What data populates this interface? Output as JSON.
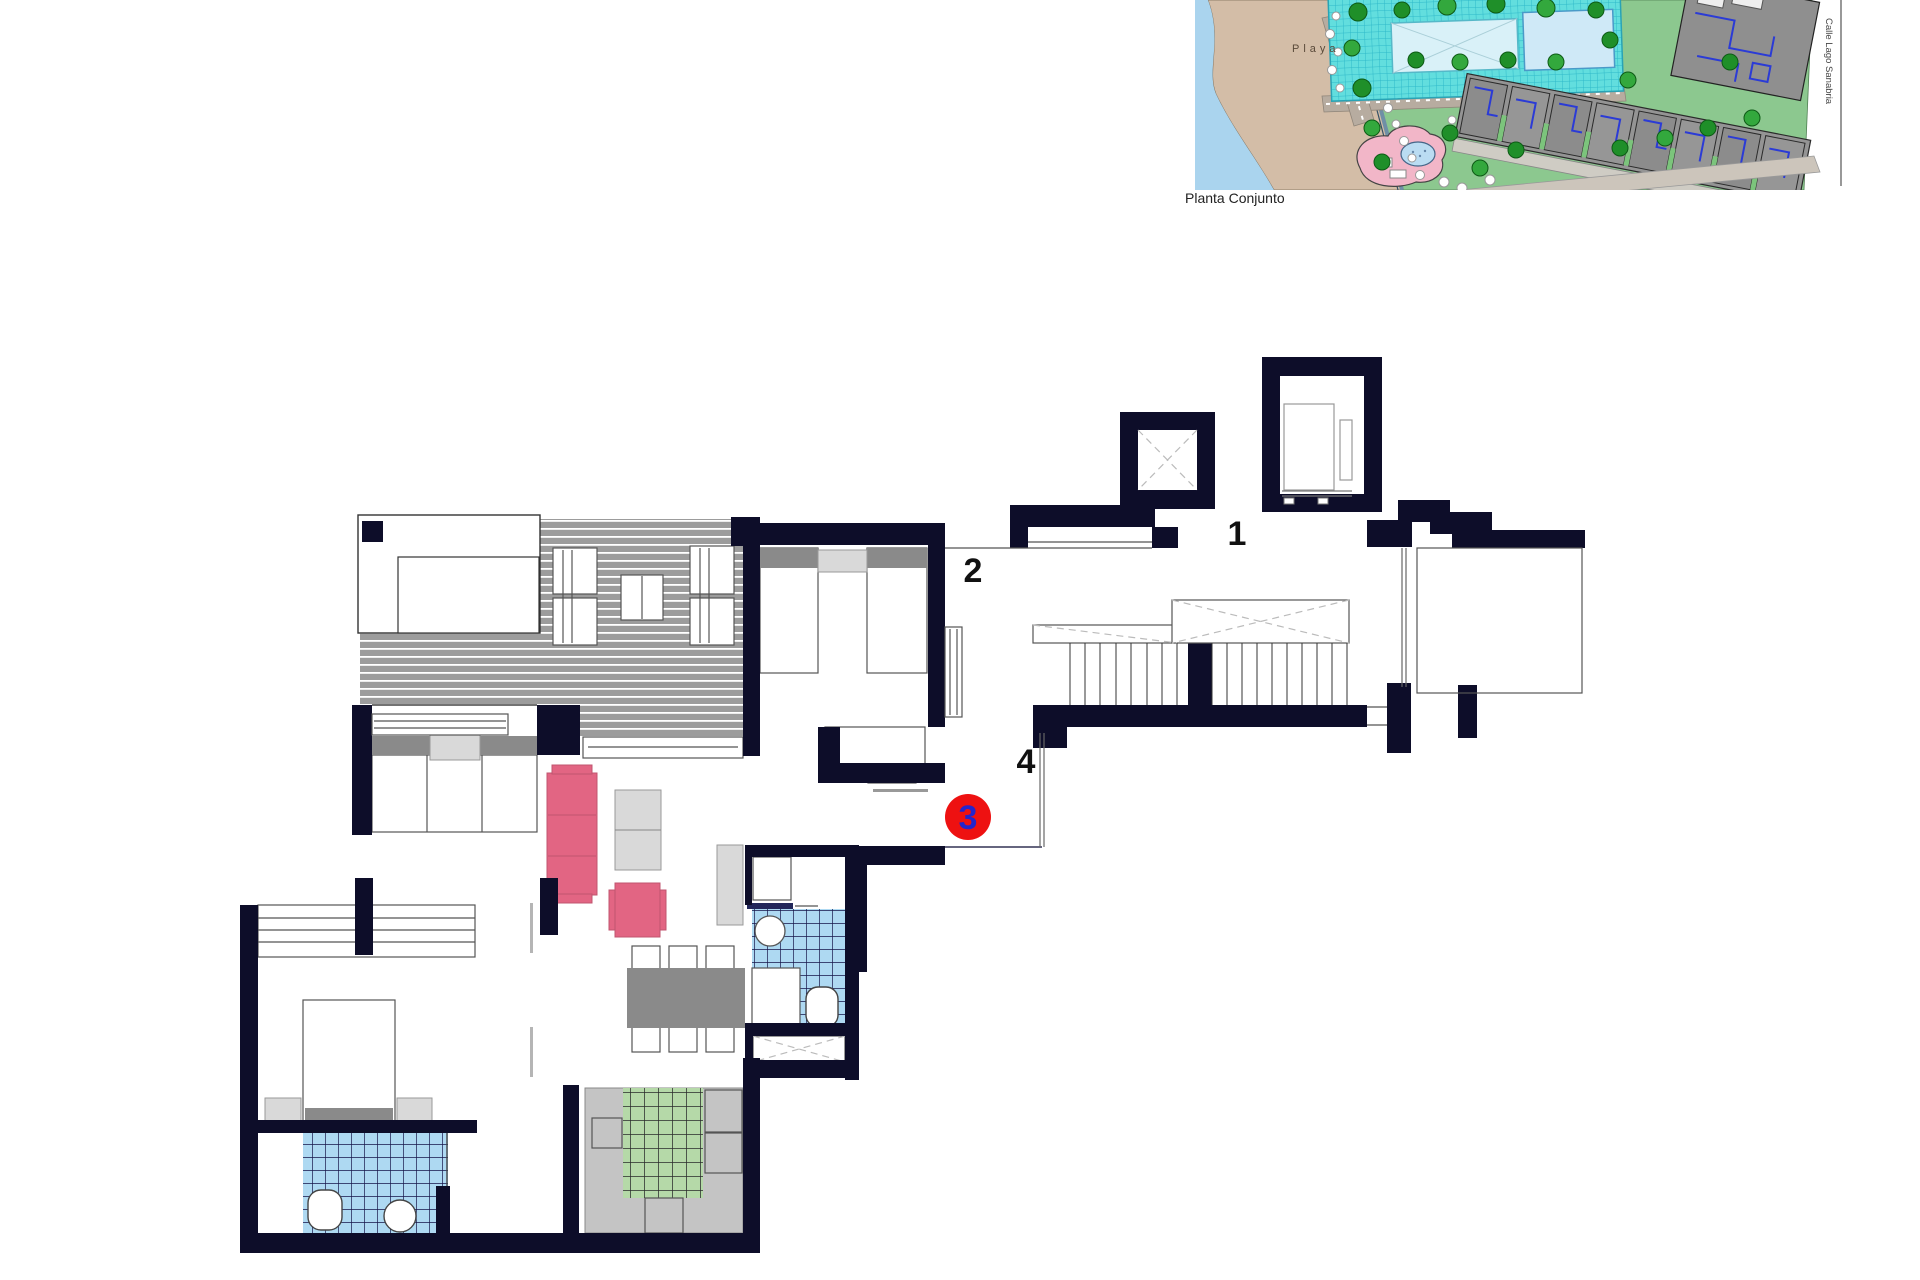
{
  "site_plan": {
    "caption": "Planta Conjunto",
    "beach_label": "Playa",
    "street_label": "Calle Lago Sanabria",
    "palette": {
      "water": "#aad4ee",
      "sand": "#d3bda7",
      "lawn": "#8cc88f",
      "pool": "#62dede",
      "building": "#8f8f8f",
      "building_lines": "#2b3bd6",
      "play_area": "#f2b6c8"
    }
  },
  "floor_plan": {
    "labels": {
      "unit1": "1",
      "unit2": "2",
      "unit4": "4"
    },
    "badge": {
      "text": "3",
      "circle_color": "#ee1111",
      "text_color": "#2424cc"
    },
    "palette": {
      "wall": "#0d0d29",
      "tile_blue": "#aed9f2",
      "tile_grid": "#16164a",
      "tile_green": "#b5d9a8",
      "deck": "#9c9c9c",
      "furniture_pink": "#e26583",
      "furniture_gray": "#8a8a8a",
      "furniture_light": "#d9d9d9"
    }
  }
}
